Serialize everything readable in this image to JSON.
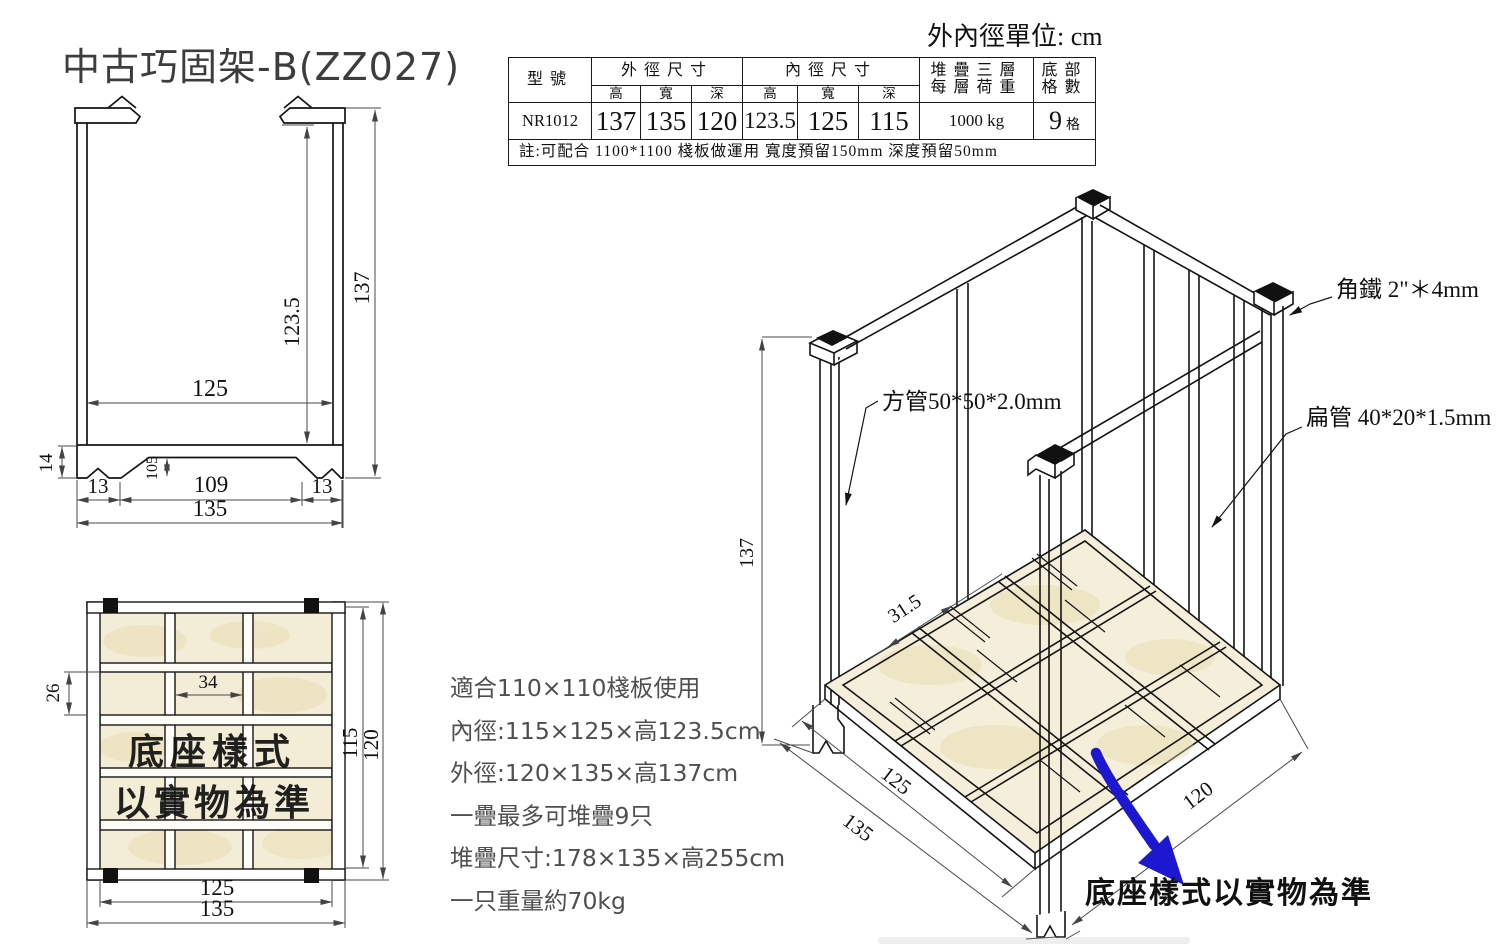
{
  "title": "中古巧固架-B(ZZ027)",
  "unit_note": "外內徑單位: cm",
  "spec_table": {
    "headers": {
      "model": "型號",
      "outer_group": "外徑尺寸",
      "inner_group": "內徑尺寸",
      "dim_h": "高",
      "dim_w": "寬",
      "dim_d": "深",
      "load_line1": "堆疊三層",
      "load_line2": "每層荷重",
      "cells": "底部格數"
    },
    "row": {
      "model": "NR1012",
      "outer_h": "137",
      "outer_w": "135",
      "outer_d": "120",
      "inner_h": "123.5",
      "inner_w": "125",
      "inner_d": "115",
      "load": "1000 kg",
      "cells_num": "9",
      "cells_unit": "格"
    },
    "note": "註:可配合 1100*1100 棧板做運用 寬度預留150mm 深度預留50mm"
  },
  "front_view": {
    "dims": {
      "inner_height": "123.5",
      "outer_height": "137",
      "inner_width": "125",
      "base_height": "14",
      "opening_height": "105",
      "foot_left": "13",
      "span": "109",
      "foot_right": "13",
      "total_width": "135"
    }
  },
  "top_view": {
    "dims": {
      "notch": "26",
      "slot": "34",
      "inner_depth": "115",
      "outer_depth": "120",
      "inner_width": "125",
      "outer_width": "135"
    },
    "overlay_line1": "底座樣式",
    "overlay_line2": "以實物為準"
  },
  "iso_view": {
    "dims": {
      "height": "137",
      "slat_spacing": "31.5",
      "inner_width": "125",
      "outer_width": "135",
      "depth": "120"
    },
    "labels": {
      "square_tube": "方管50*50*2.0mm",
      "angle_iron": "角鐵 2\"＊4mm",
      "flat_tube": "扁管 40*20*1.5mm"
    },
    "note": "底座樣式以實物為準"
  },
  "specs_list": [
    "適合110×110棧板使用",
    "內徑:115×125×高123.5cm",
    "外徑:120×135×高137cm",
    "一疊最多可堆疊9只",
    "堆疊尺寸:178×135×高255cm",
    "一只重量約70kg"
  ],
  "colors": {
    "red": "#cf2b20",
    "blue": "#1d18cf",
    "beige": "#f3ecd6",
    "line": "#141414"
  }
}
